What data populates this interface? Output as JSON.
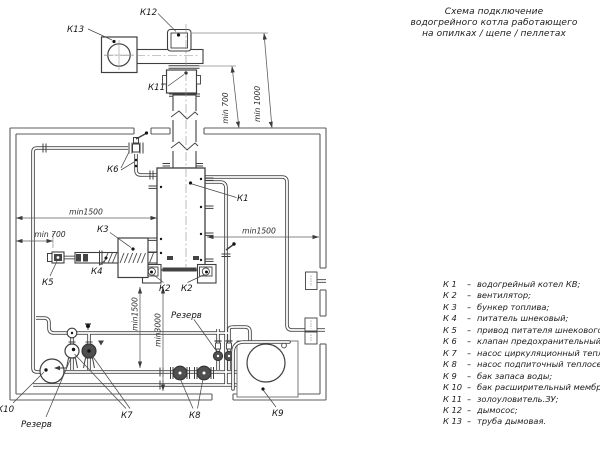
{
  "title": {
    "lines": [
      "Схема подключение",
      "водогрейного котла работающего",
      "на опилках / щепе / пеллетах"
    ]
  },
  "legend": {
    "separator": "–",
    "items": [
      {
        "key": "К 1",
        "text": "водогрейный котел КВ;"
      },
      {
        "key": "К 2",
        "text": "вентилятор;"
      },
      {
        "key": "К 3",
        "text": "бункер топлива;"
      },
      {
        "key": "К 4",
        "text": "питатель шнековый;"
      },
      {
        "key": "К 5",
        "text": "привод питателя шнекового;"
      },
      {
        "key": "К 6",
        "text": "клапан предохранительный;"
      },
      {
        "key": "К 7",
        "text": "насос циркуляционный теплосети"
      },
      {
        "key": "К 8",
        "text": "насос подпиточный теплосети"
      },
      {
        "key": "К 9",
        "text": "бак запаса воды;"
      },
      {
        "key": "К 10",
        "text": "бак расширительный мембранный"
      },
      {
        "key": "К 11",
        "text": "золоуловитель.ЗУ;"
      },
      {
        "key": "К 12",
        "text": "дымосос;"
      },
      {
        "key": "К 13",
        "text": "труба дымовая."
      }
    ]
  },
  "labels": {
    "k1": "К1",
    "k2a": "К2",
    "k2b": "К2",
    "k3": "К3",
    "k4": "К4",
    "k5": "К5",
    "k6": "К6",
    "k7": "К7",
    "k8": "К8",
    "k9": "К9",
    "k10": "К10",
    "k11": "К11",
    "k12": "К12",
    "k13": "К13",
    "reserve_top": "Резерв",
    "reserve_bottom": "Резерв"
  },
  "dims": {
    "chimney_min700": "min 700",
    "chimney_min1000": "min 1000",
    "top_min1500": "min1500",
    "left_min700": "min 700",
    "right_min1500": "min1500",
    "vert_min1500": "min1500",
    "vert_min3000": "min3000"
  },
  "colors": {
    "line": "#3f3f3f",
    "wall": "#5c5c5c",
    "text": "#1c1c1c",
    "dark_fill": "#434343",
    "background": "#ffffff"
  }
}
